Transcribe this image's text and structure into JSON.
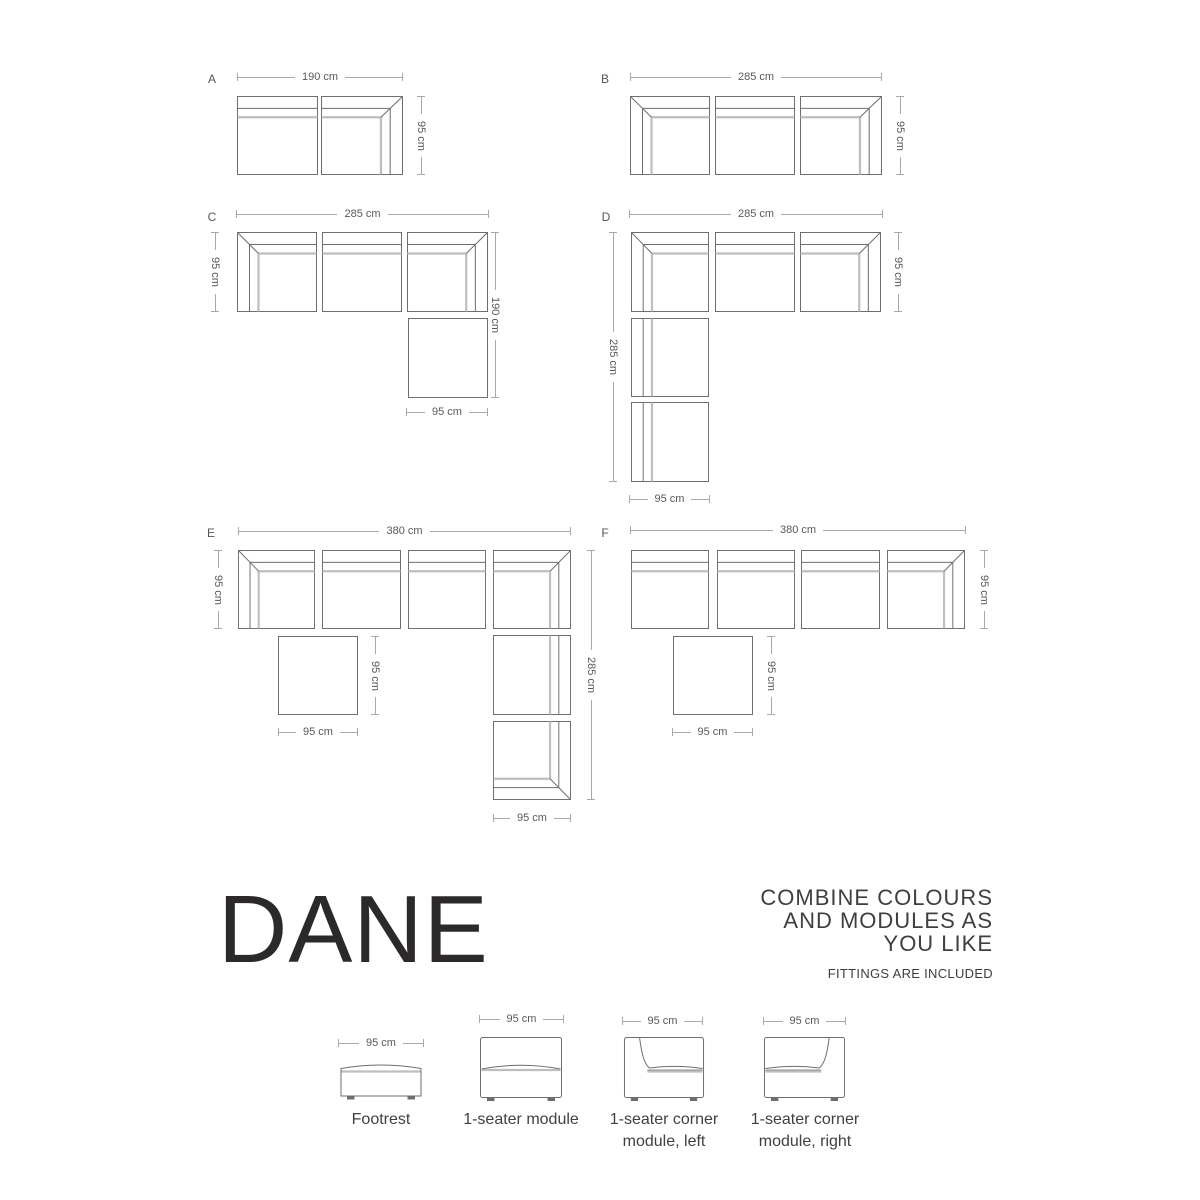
{
  "title": "DANE",
  "tagline": {
    "line1": "COMBINE COLOURS",
    "line2": "AND MODULES AS",
    "line3": "YOU LIKE",
    "note": "FITTINGS ARE INCLUDED"
  },
  "configs": {
    "a": {
      "label": "A",
      "top": "190 cm",
      "side": "95 cm"
    },
    "b": {
      "label": "B",
      "top": "285 cm",
      "side": "95 cm"
    },
    "c": {
      "label": "C",
      "top": "285 cm",
      "left": "95 cm",
      "right": "190 cm",
      "bottom": "95 cm"
    },
    "d": {
      "label": "D",
      "top": "285 cm",
      "side": "95 cm",
      "left": "285 cm",
      "bottom": "95 cm"
    },
    "e": {
      "label": "E",
      "top": "380 cm",
      "left": "95 cm",
      "footrest_side": "95 cm",
      "footrest_bottom": "95 cm",
      "right": "285 cm",
      "bottom": "95 cm"
    },
    "f": {
      "label": "F",
      "top": "380 cm",
      "side": "95 cm",
      "footrest_side": "95 cm",
      "footrest_bottom": "95 cm"
    }
  },
  "catalog": {
    "items": [
      {
        "dim": "95 cm",
        "lines": [
          "Footrest"
        ]
      },
      {
        "dim": "95 cm",
        "lines": [
          "1-seater module"
        ]
      },
      {
        "dim": "95 cm",
        "lines": [
          "1-seater corner",
          "module, left"
        ]
      },
      {
        "dim": "95 cm",
        "lines": [
          "1-seater corner",
          "module, right"
        ]
      }
    ]
  },
  "colors": {
    "outline": "#6d6e71",
    "cushion": "#bcbec0",
    "dim_line": "#a7a9ac",
    "dim_text": "#58595b",
    "text": "#414042",
    "title": "#2b292a"
  }
}
